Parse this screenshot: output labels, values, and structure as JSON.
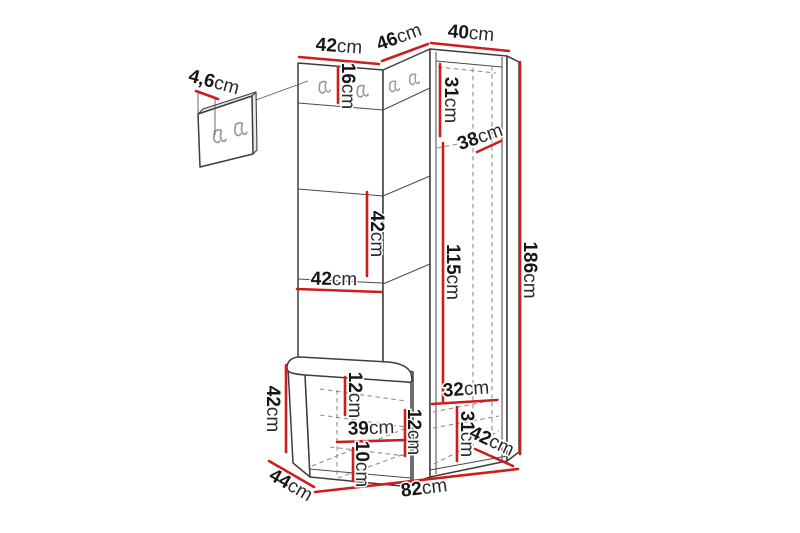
{
  "figure": {
    "kind": "furniture-dimension-diagram",
    "unit": "cm"
  },
  "colors": {
    "dimension_red": "#cf1d1d",
    "outline": "#3d3d3d",
    "dashed_gray": "#8f8f8f",
    "hook_gray": "#9a9a9a",
    "background": "#ffffff"
  },
  "dimensions": {
    "panel_thickness": {
      "v": "4,6",
      "u": "cm"
    },
    "top_left_width": {
      "v": "42",
      "u": "cm"
    },
    "top_corner_width": {
      "v": "46",
      "u": "cm"
    },
    "top_right_width": {
      "v": "40",
      "u": "cm"
    },
    "hook_rail_height": {
      "v": "16",
      "u": "cm"
    },
    "right_upper_inner_height": {
      "v": "31",
      "u": "cm"
    },
    "right_inner_depth": {
      "v": "38",
      "u": "cm"
    },
    "right_door_opening_height": {
      "v": "115",
      "u": "cm"
    },
    "total_height": {
      "v": "186",
      "u": "cm"
    },
    "left_middle_section_height": {
      "v": "42",
      "u": "cm"
    },
    "left_panel_width": {
      "v": "42",
      "u": "cm"
    },
    "bench_height": {
      "v": "42",
      "u": "cm"
    },
    "bench_top_inner_height": {
      "v": "12",
      "u": "cm"
    },
    "bench_inner_width": {
      "v": "39",
      "u": "cm"
    },
    "bench_right_inner_height": {
      "v": "12",
      "u": "cm"
    },
    "bench_bottom_inner_height": {
      "v": "10",
      "u": "cm"
    },
    "right_bottom_inner_width": {
      "v": "32",
      "u": "cm"
    },
    "right_bottom_section_height": {
      "v": "31",
      "u": "cm"
    },
    "right_unit_depth": {
      "v": "42",
      "u": "cm"
    },
    "bench_depth": {
      "v": "44",
      "u": "cm"
    },
    "total_width": {
      "v": "82",
      "u": "cm"
    }
  }
}
